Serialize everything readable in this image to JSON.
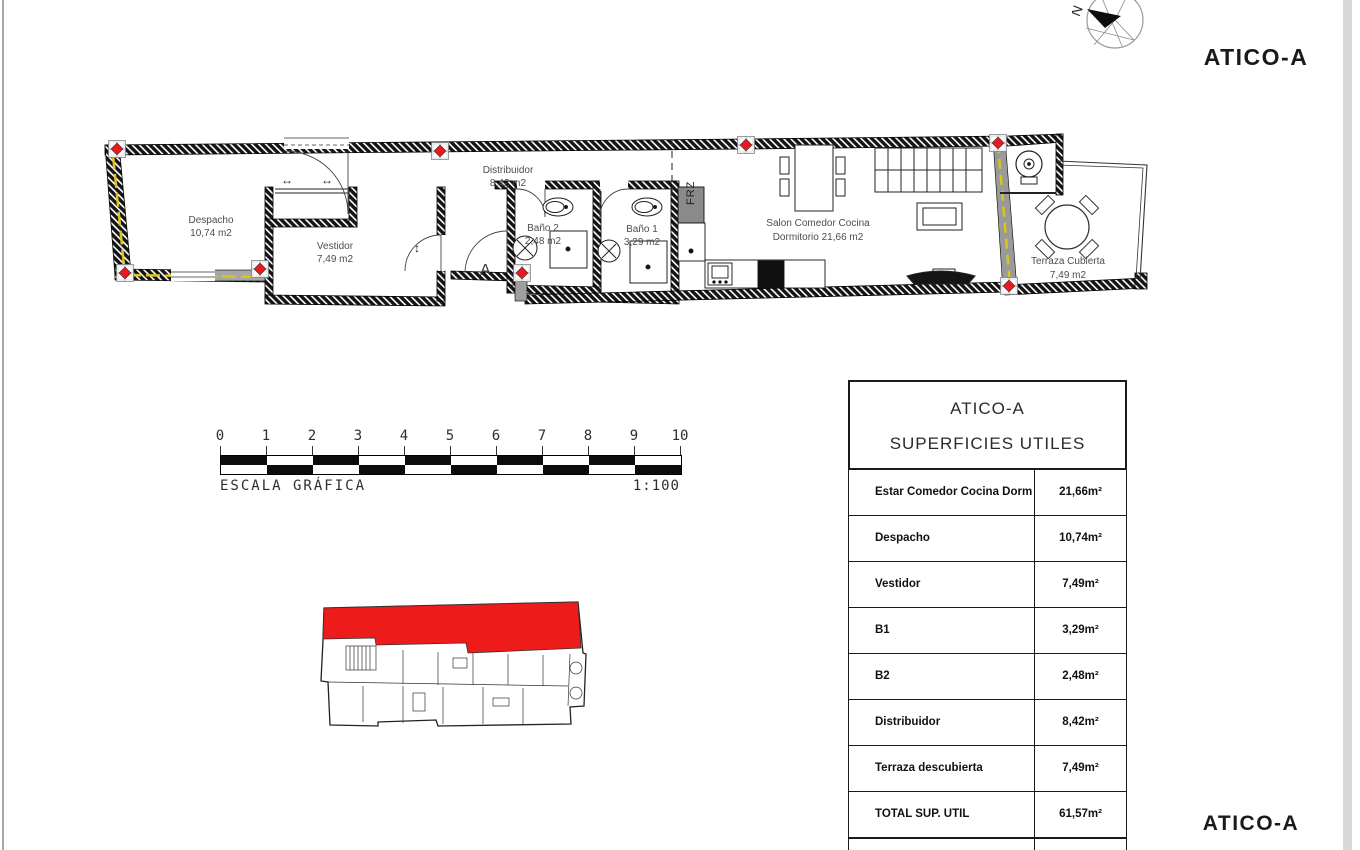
{
  "page": {
    "title_top": "ATICO-A",
    "title_bottom": "ATICO-A"
  },
  "compass": {
    "north_label": "N"
  },
  "plan": {
    "rooms": [
      {
        "name": "Despacho",
        "area": "10,74 m2"
      },
      {
        "name": "Vestidor",
        "area": "7,49 m2"
      },
      {
        "name": "Distribuidor",
        "area": "8,42 m2"
      },
      {
        "name": "Baño 2",
        "area": "2,48 m2"
      },
      {
        "name": "Baño 1",
        "area": "3,29 m2"
      },
      {
        "name": "Salon Comedor Cocina",
        "area": "Dormitorio 21,66 m2"
      },
      {
        "name": "Terraza Cubierta",
        "area": "7,49 m2"
      }
    ],
    "labels": {
      "frz": "FRZ",
      "section": "A",
      "arrow_h": "↔",
      "arrow_v": "↕"
    }
  },
  "scalebar": {
    "ticks": [
      "0",
      "1",
      "2",
      "3",
      "4",
      "5",
      "6",
      "7",
      "8",
      "9",
      "10"
    ],
    "label": "ESCALA GRÁFICA",
    "ratio": "1:100"
  },
  "table": {
    "title1": "ATICO-A",
    "title2": "SUPERFICIES UTILES",
    "rows": [
      {
        "label": "Estar Comedor Cocina Dorm",
        "value": "21,66m²"
      },
      {
        "label": "Despacho",
        "value": "10,74m²"
      },
      {
        "label": "Vestidor",
        "value": "7,49m²"
      },
      {
        "label": "B1",
        "value": "3,29m²"
      },
      {
        "label": "B2",
        "value": "2,48m²"
      },
      {
        "label": "Distribuidor",
        "value": "8,42m²"
      },
      {
        "label": "Terraza descubierta",
        "value": "7,49m²"
      },
      {
        "label": "TOTAL SUP. UTIL",
        "value": "61,57m²"
      }
    ]
  },
  "colors": {
    "accent_red": "#e8191f",
    "insulation_yellow": "#d9c420",
    "wall": "#141414"
  }
}
